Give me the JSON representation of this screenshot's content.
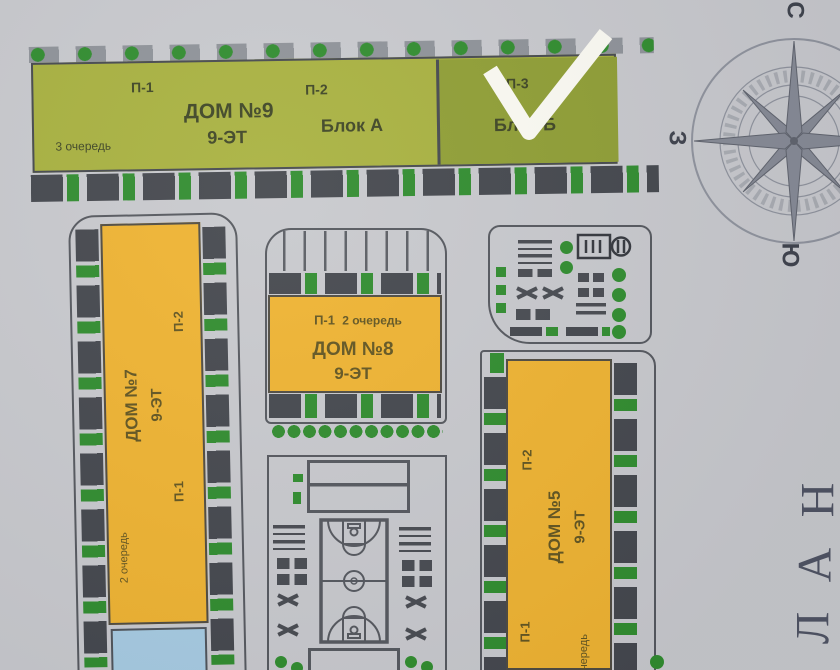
{
  "plan": {
    "dom9": {
      "p1": "П-1",
      "p2": "П-2",
      "p3": "П-3",
      "name": "ДОМ №9",
      "floors": "9-ЭТ",
      "block_a": "Блок А",
      "block_b": "Блок Б",
      "queue": "3 очередь"
    },
    "dom7": {
      "p1": "П-1",
      "p2": "П-2",
      "name": "ДОМ №7",
      "floors": "9-ЭТ",
      "queue": "2 очередь"
    },
    "dom8": {
      "p1": "П-1",
      "name": "ДОМ №8",
      "floors": "9-ЭТ",
      "queue": "2 очередь"
    },
    "dom5": {
      "p1": "П-1",
      "p2": "П-2",
      "name": "ДОМ №5",
      "floors": "9-ЭТ",
      "queue": "очередь"
    }
  },
  "compass": {
    "north": "С",
    "south": "Ю",
    "west": "З"
  },
  "edge_word": {
    "letter1": "Н",
    "letter2": "А",
    "letter3": "Л"
  },
  "colors": {
    "block_a": "#a8b13e",
    "block_b": "#8f9e33",
    "building_yellow": "#efb330",
    "building_blue": "#a6cbe2",
    "bush_green": "#2f8c2d",
    "checkmark": "#fcfbf3",
    "background": "#c8c9cd",
    "outline_gray": "#54575d"
  }
}
